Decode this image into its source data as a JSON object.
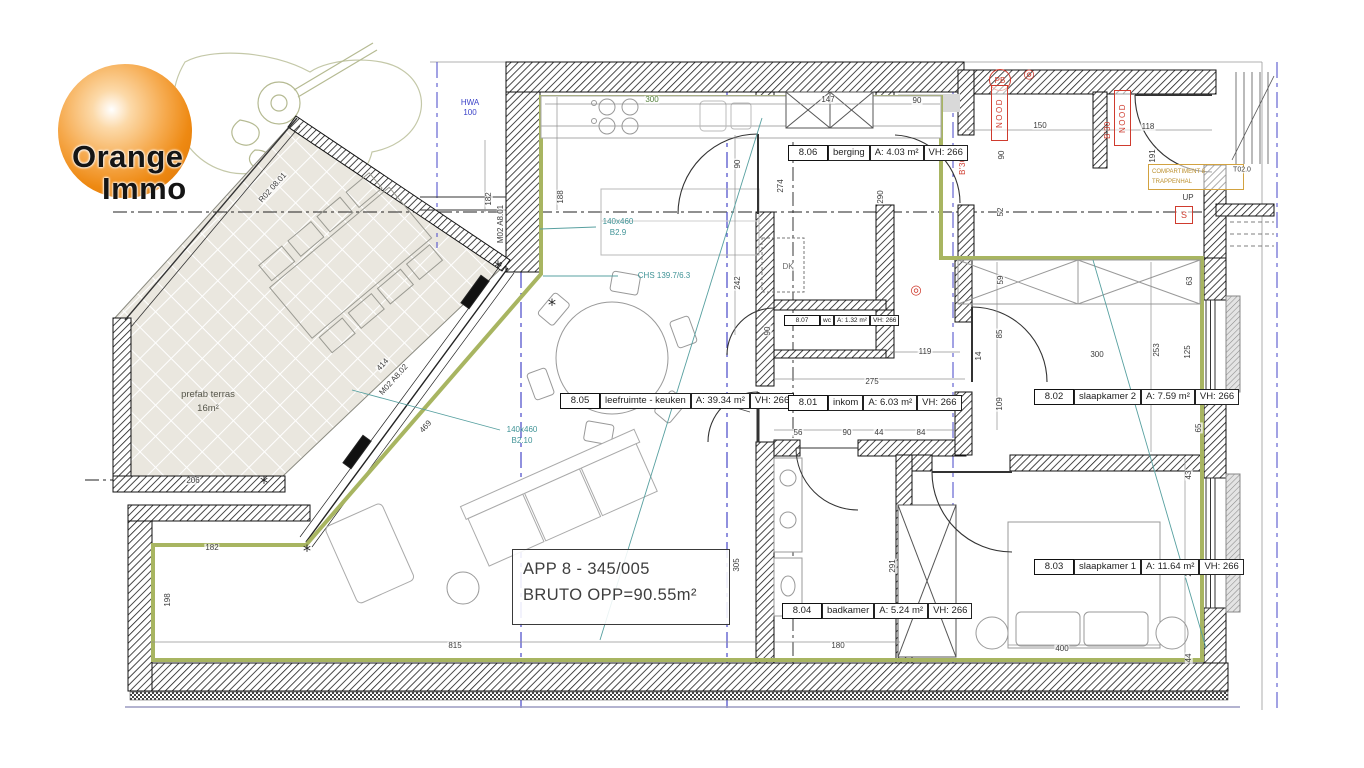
{
  "logo": {
    "line1": "Orange",
    "line2": "Immo"
  },
  "title_box": {
    "line1": "APP 8 - 345/005",
    "line2": "BRUTO OPP=90.55m²"
  },
  "terrace": {
    "line1": "prefab terras",
    "line2": "16m²"
  },
  "compartiment": {
    "line1": "COMPARTIMENT 8",
    "line2": "TRAPPENHAL"
  },
  "rooms": [
    {
      "number": "8.05",
      "name": "leefruimte - keuken",
      "area": "A: 39.34 m²",
      "height": "VH: 266",
      "x": 560,
      "y": 392,
      "small": false
    },
    {
      "number": "8.01",
      "name": "inkom",
      "area": "A: 6.03 m²",
      "height": "VH: 266",
      "x": 788,
      "y": 394,
      "small": false
    },
    {
      "number": "8.02",
      "name": "slaapkamer 2",
      "area": "A: 7.59 m²",
      "height": "VH: 266",
      "x": 1034,
      "y": 388,
      "small": false
    },
    {
      "number": "8.03",
      "name": "slaapkamer 1",
      "area": "A: 11.64 m²",
      "height": "VH: 266",
      "x": 1034,
      "y": 558,
      "small": false
    },
    {
      "number": "8.04",
      "name": "badkamer",
      "area": "A: 5.24 m²",
      "height": "VH: 266",
      "x": 782,
      "y": 602,
      "small": false
    },
    {
      "number": "8.06",
      "name": "berging",
      "area": "A: 4.03 m²",
      "height": "VH: 266",
      "x": 788,
      "y": 144,
      "small": false
    },
    {
      "number": "8.07",
      "name": "wc",
      "area": "A: 1.32 m²",
      "height": "VH: 266",
      "x": 784,
      "y": 314,
      "small": true
    }
  ],
  "red": {
    "nood_label": "NOOD",
    "nood_positions": [
      {
        "x": 998,
        "y": 112
      },
      {
        "x": 1121,
        "y": 117
      }
    ],
    "pb": {
      "t": "PB",
      "x": 999,
      "y": 79
    },
    "s": {
      "t": "S",
      "x": 1183,
      "y": 214
    },
    "spiral_char": "◎",
    "spiral_positions": [
      {
        "x": 1029,
        "y": 74
      },
      {
        "x": 916,
        "y": 290
      }
    ]
  },
  "annotations": [
    {
      "t": "300",
      "x": 652,
      "y": 100,
      "c": "green"
    },
    {
      "t": "147",
      "x": 828,
      "y": 100
    },
    {
      "t": "90",
      "x": 917,
      "y": 101
    },
    {
      "t": "150",
      "x": 1040,
      "y": 126
    },
    {
      "t": "118",
      "x": 1148,
      "y": 127
    },
    {
      "t": "HWA",
      "x": 470,
      "y": 103,
      "c": "blue"
    },
    {
      "t": "100",
      "x": 470,
      "y": 113,
      "c": "blue"
    },
    {
      "t": "182",
      "x": 489,
      "y": 199,
      "r": -90
    },
    {
      "t": "M02 A8.01",
      "x": 501,
      "y": 224,
      "r": -90
    },
    {
      "t": "188",
      "x": 561,
      "y": 197,
      "r": -90
    },
    {
      "t": "274",
      "x": 781,
      "y": 186,
      "r": -90
    },
    {
      "t": "290",
      "x": 881,
      "y": 197,
      "r": -90
    },
    {
      "t": "90",
      "x": 1002,
      "y": 155,
      "r": -90
    },
    {
      "t": "52",
      "x": 1001,
      "y": 212,
      "r": -90
    },
    {
      "t": "191",
      "x": 1153,
      "y": 156,
      "r": -90
    },
    {
      "t": "B'30",
      "x": 963,
      "y": 166,
      "r": -90,
      "c": "red"
    },
    {
      "t": "B'30",
      "x": 1108,
      "y": 130,
      "r": -90,
      "c": "red"
    },
    {
      "t": "R02 08.01",
      "x": 273,
      "y": 188,
      "r": -48
    },
    {
      "t": "414",
      "x": 383,
      "y": 365,
      "r": -48
    },
    {
      "t": "M02 A8.02",
      "x": 394,
      "y": 380,
      "r": -48
    },
    {
      "t": "469",
      "x": 426,
      "y": 427,
      "r": -48
    },
    {
      "t": "140x460",
      "x": 618,
      "y": 222,
      "c": "teal"
    },
    {
      "t": "B2.9",
      "x": 618,
      "y": 233,
      "c": "teal"
    },
    {
      "t": "CHS 139.7/6.3",
      "x": 664,
      "y": 276,
      "c": "teal"
    },
    {
      "t": "140x460",
      "x": 522,
      "y": 430,
      "c": "teal"
    },
    {
      "t": "B2.10",
      "x": 522,
      "y": 441,
      "c": "teal"
    },
    {
      "t": "deur in glas",
      "x": 692,
      "y": 399,
      "c": "small"
    },
    {
      "t": "DK",
      "x": 788,
      "y": 267,
      "c": "gray"
    },
    {
      "t": "90",
      "x": 738,
      "y": 164,
      "r": -90
    },
    {
      "t": "242",
      "x": 738,
      "y": 283,
      "r": -90
    },
    {
      "t": "90",
      "x": 768,
      "y": 331,
      "r": -90
    },
    {
      "t": "119",
      "x": 925,
      "y": 352
    },
    {
      "t": "275",
      "x": 872,
      "y": 382
    },
    {
      "t": "56",
      "x": 798,
      "y": 433
    },
    {
      "t": "90",
      "x": 847,
      "y": 433
    },
    {
      "t": "44",
      "x": 879,
      "y": 433
    },
    {
      "t": "84",
      "x": 921,
      "y": 433
    },
    {
      "t": "59",
      "x": 1001,
      "y": 280,
      "r": -90
    },
    {
      "t": "85",
      "x": 1000,
      "y": 334,
      "r": -90
    },
    {
      "t": "14",
      "x": 979,
      "y": 356,
      "r": -90
    },
    {
      "t": "109",
      "x": 1000,
      "y": 404,
      "r": -90
    },
    {
      "t": "300",
      "x": 1097,
      "y": 355
    },
    {
      "t": "253",
      "x": 1157,
      "y": 350,
      "r": -90
    },
    {
      "t": "125",
      "x": 1188,
      "y": 352,
      "r": -90
    },
    {
      "t": "63",
      "x": 1190,
      "y": 281,
      "r": -90
    },
    {
      "t": "65",
      "x": 1199,
      "y": 428,
      "r": -90
    },
    {
      "t": "305",
      "x": 737,
      "y": 565,
      "r": -90
    },
    {
      "t": "291",
      "x": 893,
      "y": 566,
      "r": -90
    },
    {
      "t": "291",
      "x": 1153,
      "y": 567,
      "r": -90
    },
    {
      "t": "43",
      "x": 1189,
      "y": 475,
      "r": -90
    },
    {
      "t": "204",
      "x": 1189,
      "y": 570,
      "r": -90
    },
    {
      "t": "44",
      "x": 1189,
      "y": 658,
      "r": -90
    },
    {
      "t": "206",
      "x": 193,
      "y": 481
    },
    {
      "t": "182",
      "x": 212,
      "y": 548
    },
    {
      "t": "198",
      "x": 168,
      "y": 600,
      "r": -90
    },
    {
      "t": "815",
      "x": 455,
      "y": 646
    },
    {
      "t": "180",
      "x": 838,
      "y": 646
    },
    {
      "t": "400",
      "x": 1062,
      "y": 649
    },
    {
      "t": "UP",
      "x": 1188,
      "y": 198
    },
    {
      "t": "T02.0",
      "x": 1242,
      "y": 170,
      "c": "small"
    }
  ],
  "colors": {
    "boundary_green": "#a8b561",
    "annotation_teal": "#3f9396",
    "grid_blue": "#4646c8",
    "alert_red": "#cf3b2e",
    "compartment_orange": "#c89a33",
    "logo_orange": "#ee8912"
  }
}
